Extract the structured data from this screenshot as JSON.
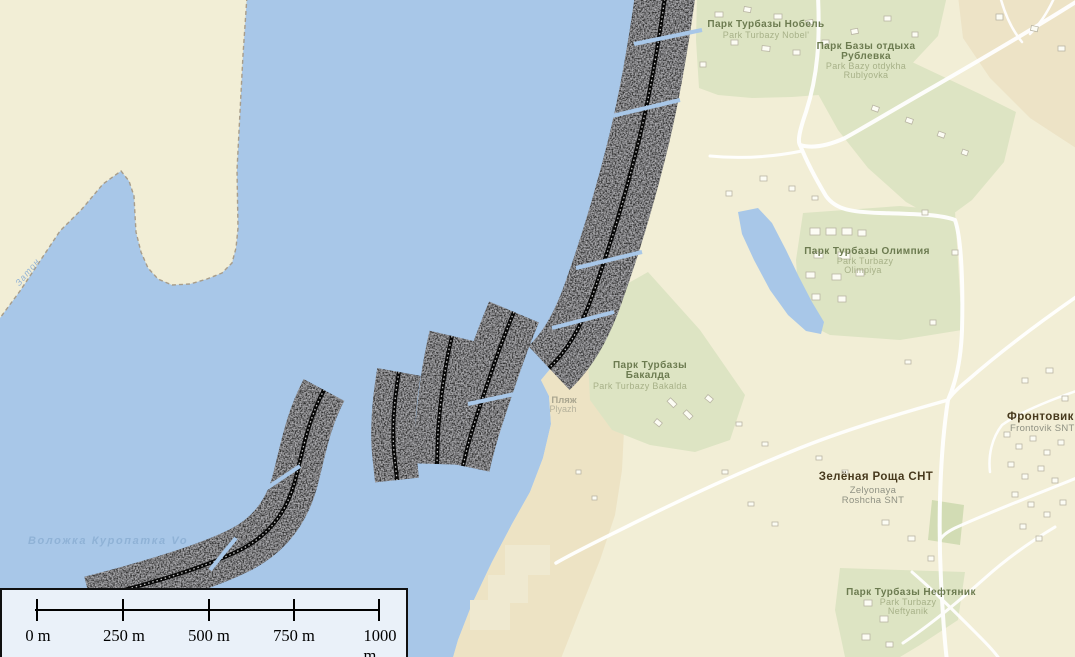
{
  "map": {
    "labels": {
      "nobel": {
        "ru": "Парк Турбазы Нобель",
        "en": "Park Turbazy Nobel'"
      },
      "rublevka": {
        "ru1": "Парк Базы отдыха",
        "ru2": "Рублевка",
        "en1": "Park Bazy otdykha",
        "en2": "Rublyovka"
      },
      "olimpiya": {
        "ru": "Парк Турбазы Олимпия",
        "en1": "Park Turbazy",
        "en2": "Olimpiya"
      },
      "bakalda": {
        "ru1": "Парк Турбазы",
        "ru2": "Бакалда",
        "en": "Park Turbazy Bakalda"
      },
      "plyazh": {
        "ru": "Пляж",
        "en": "Plyazh"
      },
      "frontovik": {
        "ru": "Фронтовик СНТ",
        "en": "Frontovik SNT"
      },
      "zelyonaya": {
        "ru": "Зелёная Роща СНТ",
        "en1": "Zelyonaya",
        "en2": "Roshcha SNT"
      },
      "neftyanik": {
        "ru": "Парк Турбазы Нефтяник",
        "en1": "Park Turbazy",
        "en2": "Neftyanik"
      },
      "volozhka": {
        "ru": "Воложка Куропатка Vo"
      },
      "zaton": {
        "ru": "Затон"
      }
    },
    "scale_bar": {
      "ticks": [
        "0 m",
        "250 m",
        "500 m",
        "750 m",
        "1000 m"
      ]
    },
    "colors": {
      "water": "#a8c7e8",
      "land": "#f2eed6",
      "park_green": "#dde4c3",
      "sand": "#ece1c1",
      "road": "#ffffff",
      "sonar_dark": "#303033",
      "scalebox_bg": "#eaf1f9"
    }
  }
}
